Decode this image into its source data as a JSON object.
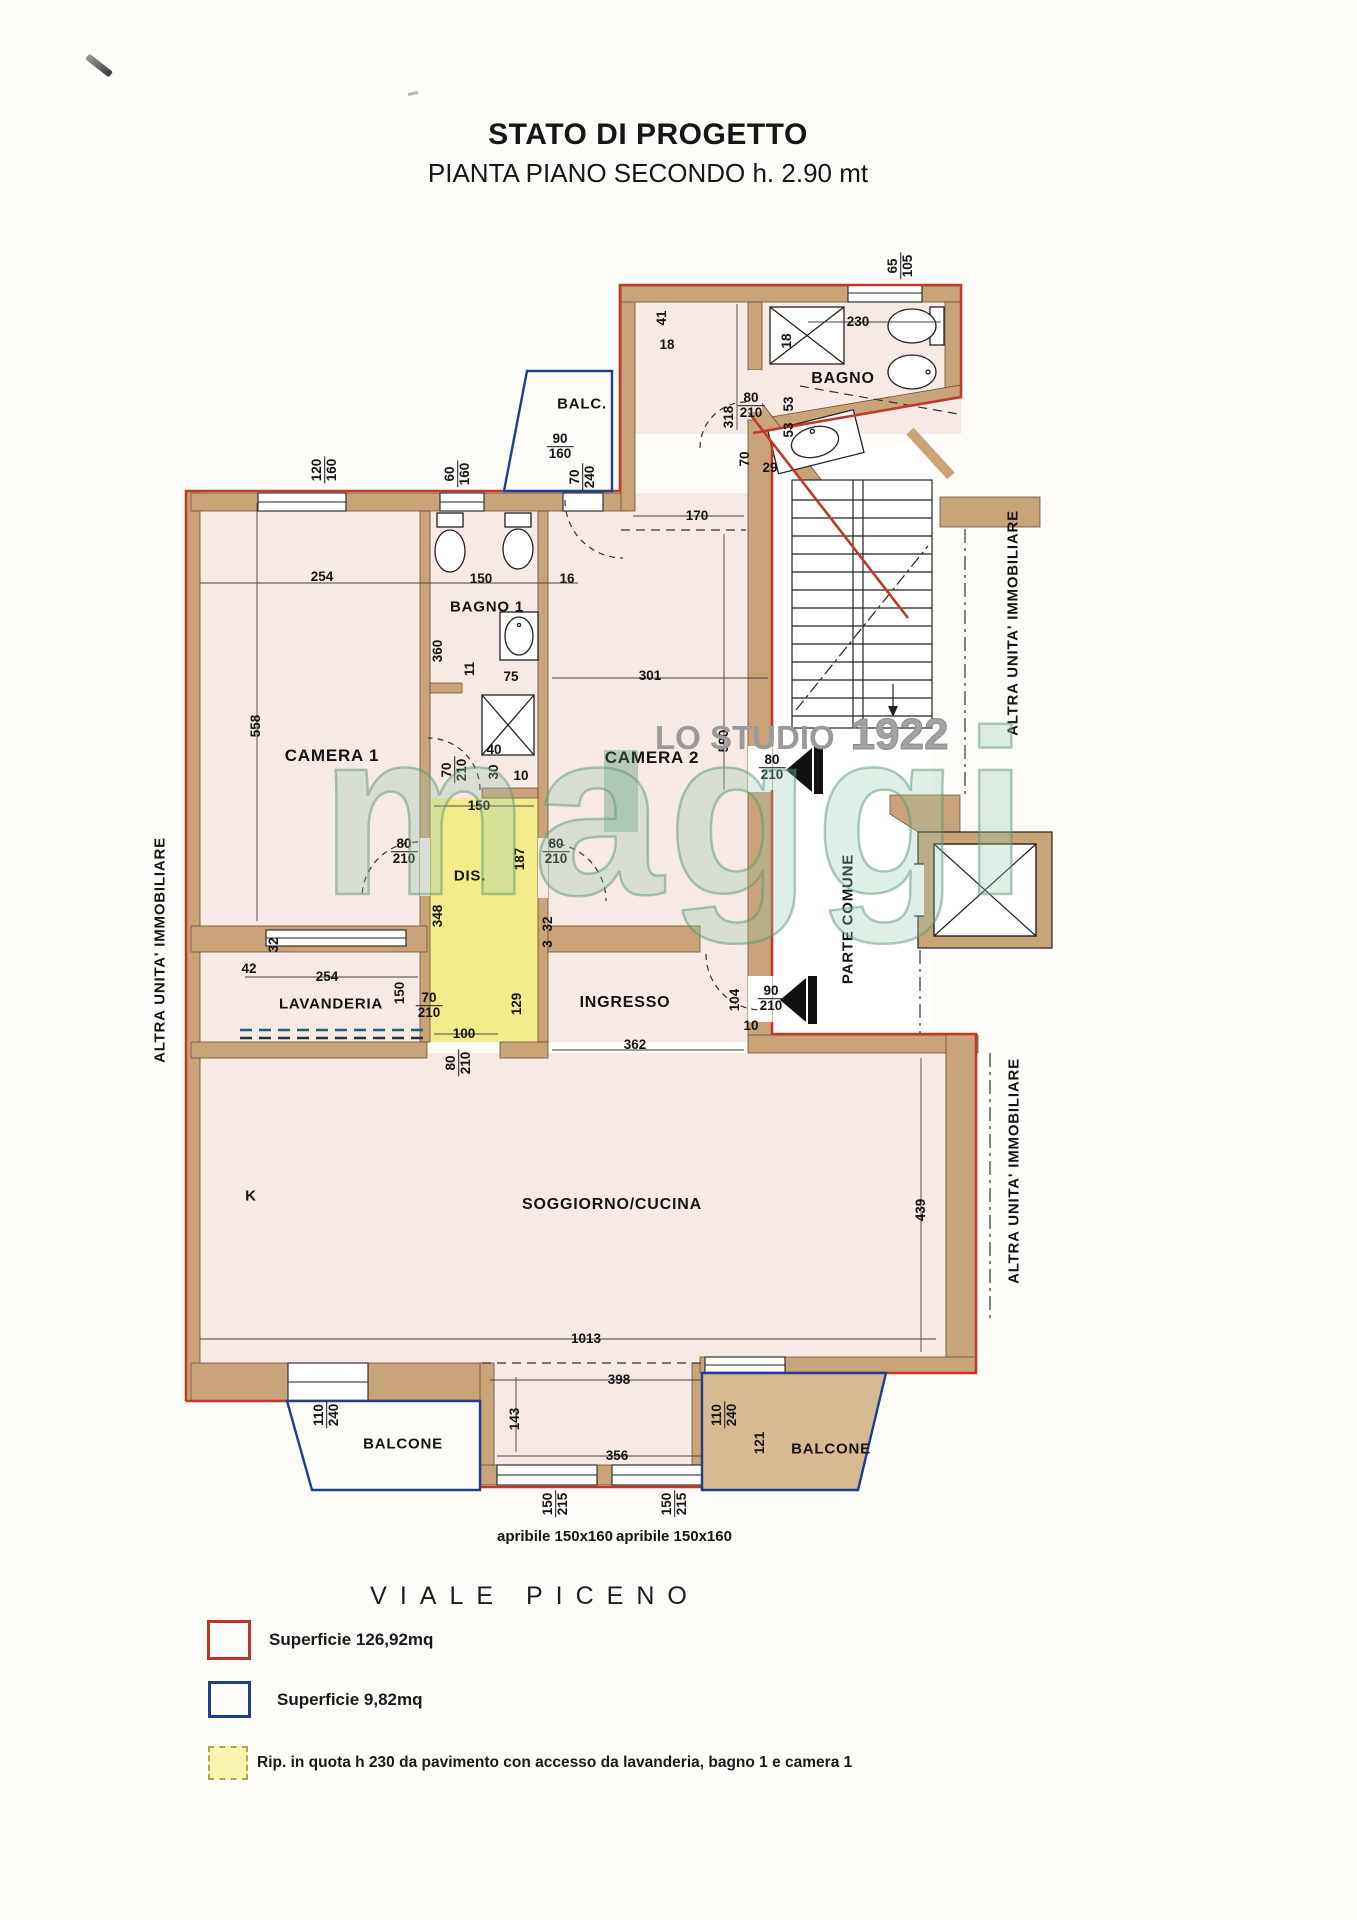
{
  "title": {
    "line1": "STATO DI PROGETTO",
    "line2": "PIANTA PIANO SECONDO h. 2.90 mt"
  },
  "street_label": "VIALE PICENO",
  "watermark": {
    "studio_label": "LO STUDIO",
    "year": "1922",
    "logo_text": "maggi"
  },
  "legend": [
    {
      "swatch": "red-outline",
      "color": "#c0332b",
      "label": "Superficie 126,92mq"
    },
    {
      "swatch": "blue-outline",
      "color": "#1c3f8e",
      "label": "Superficie 9,82mq"
    },
    {
      "swatch": "yellow-dashed",
      "color": "#f8f4ad",
      "label": "Rip. in quota h 230 da pavimento con accesso da lavanderia, bagno 1 e camera 1"
    }
  ],
  "colors": {
    "apartment_outline": "#bf3a2b",
    "balcony_outline": "#1c3f8e",
    "wall_fill": "#c9a478",
    "room_fill": "#f7e9e3",
    "ripostiglio_fill": "#f3ec8b",
    "watermark_green": "#7ab494"
  },
  "plan": {
    "labels": [
      {
        "t": "BALC.",
        "x": 582,
        "y": 404,
        "s": 15
      },
      {
        "t": "BAGNO",
        "x": 843,
        "y": 379,
        "s": 16
      },
      {
        "t": "BAGNO 1",
        "x": 487,
        "y": 607,
        "s": 15
      },
      {
        "t": "CAMERA 1",
        "x": 332,
        "y": 756,
        "s": 17
      },
      {
        "t": "CAMERA 2",
        "x": 652,
        "y": 758,
        "s": 17
      },
      {
        "t": "DIS.",
        "x": 470,
        "y": 876,
        "s": 15
      },
      {
        "t": "LAVANDERIA",
        "x": 331,
        "y": 1004,
        "s": 15
      },
      {
        "t": "INGRESSO",
        "x": 625,
        "y": 1003,
        "s": 16
      },
      {
        "t": "PARTE COMUNE",
        "x": 848,
        "y": 919,
        "r": -90,
        "s": 15
      },
      {
        "t": "SOGGIORNO/CUCINA",
        "x": 612,
        "y": 1205,
        "s": 16
      },
      {
        "t": "K",
        "x": 251,
        "y": 1196,
        "s": 15
      },
      {
        "t": "BALCONE",
        "x": 403,
        "y": 1444,
        "s": 15
      },
      {
        "t": "BALCONE",
        "x": 831,
        "y": 1449,
        "s": 15
      },
      {
        "t": "ALTRA UNITA' IMMOBILIARE",
        "x": 160,
        "y": 950,
        "r": -90,
        "s": 15
      },
      {
        "t": "ALTRA UNITA' IMMOBILIARE",
        "x": 1013,
        "y": 623,
        "r": -90,
        "s": 15
      },
      {
        "t": "ALTRA UNITA' IMMOBILIARE",
        "x": 1014,
        "y": 1171,
        "r": -90,
        "s": 15
      }
    ],
    "dims": [
      {
        "t": "65",
        "t2": "105",
        "x": 901,
        "y": 266,
        "r": -90
      },
      {
        "t": "41",
        "x": 662,
        "y": 318,
        "r": -90
      },
      {
        "t": "18",
        "x": 667,
        "y": 345
      },
      {
        "t": "230",
        "x": 858,
        "y": 322
      },
      {
        "t": "18",
        "x": 787,
        "y": 341,
        "r": -90
      },
      {
        "t": "80",
        "t2": "210",
        "x": 751,
        "y": 406
      },
      {
        "t": "53",
        "x": 789,
        "y": 404,
        "r": -90
      },
      {
        "t": "53",
        "x": 789,
        "y": 430,
        "r": -90
      },
      {
        "t": "70",
        "x": 745,
        "y": 459,
        "r": -90
      },
      {
        "t": "29",
        "x": 770,
        "y": 468
      },
      {
        "t": "318",
        "x": 729,
        "y": 417,
        "r": -90
      },
      {
        "t": "170",
        "x": 697,
        "y": 516
      },
      {
        "t": "120",
        "t2": "160",
        "x": 325,
        "y": 470,
        "r": -90
      },
      {
        "t": "60",
        "t2": "160",
        "x": 458,
        "y": 474,
        "r": -90
      },
      {
        "t": "90",
        "t2": "160",
        "x": 560,
        "y": 447
      },
      {
        "t": "70",
        "t2": "240",
        "x": 583,
        "y": 477,
        "r": -90
      },
      {
        "t": "254",
        "x": 322,
        "y": 577
      },
      {
        "t": "150",
        "x": 481,
        "y": 579
      },
      {
        "t": "16",
        "x": 567,
        "y": 579
      },
      {
        "t": "558",
        "x": 256,
        "y": 726,
        "r": -90
      },
      {
        "t": "360",
        "x": 438,
        "y": 651,
        "r": -90
      },
      {
        "t": "11",
        "x": 470,
        "y": 669,
        "r": -90
      },
      {
        "t": "75",
        "x": 511,
        "y": 677
      },
      {
        "t": "301",
        "x": 650,
        "y": 676
      },
      {
        "t": "590",
        "x": 724,
        "y": 741,
        "r": -90
      },
      {
        "t": "80",
        "t2": "210",
        "x": 772,
        "y": 768
      },
      {
        "t": "40",
        "x": 494,
        "y": 750
      },
      {
        "t": "30",
        "x": 494,
        "y": 772,
        "r": -90
      },
      {
        "t": "10",
        "x": 521,
        "y": 776
      },
      {
        "t": "70",
        "t2": "210",
        "x": 455,
        "y": 770,
        "r": -90
      },
      {
        "t": "150",
        "x": 479,
        "y": 806
      },
      {
        "t": "80",
        "t2": "210",
        "x": 404,
        "y": 852
      },
      {
        "t": "80",
        "t2": "210",
        "x": 556,
        "y": 852
      },
      {
        "t": "187",
        "x": 520,
        "y": 859,
        "r": -90
      },
      {
        "t": "348",
        "x": 438,
        "y": 916,
        "r": -90
      },
      {
        "t": "32",
        "x": 548,
        "y": 924,
        "r": -90
      },
      {
        "t": "3",
        "x": 548,
        "y": 944,
        "r": -90
      },
      {
        "t": "42",
        "x": 249,
        "y": 969
      },
      {
        "t": "32",
        "x": 274,
        "y": 945,
        "r": -90
      },
      {
        "t": "254",
        "x": 327,
        "y": 977
      },
      {
        "t": "150",
        "x": 400,
        "y": 993,
        "r": -90
      },
      {
        "t": "70",
        "t2": "210",
        "x": 429,
        "y": 1006
      },
      {
        "t": "100",
        "x": 464,
        "y": 1034
      },
      {
        "t": "80",
        "t2": "210",
        "x": 459,
        "y": 1063,
        "r": -90
      },
      {
        "t": "129",
        "x": 517,
        "y": 1004,
        "r": -90
      },
      {
        "t": "362",
        "x": 635,
        "y": 1045
      },
      {
        "t": "104",
        "x": 735,
        "y": 1000,
        "r": -90
      },
      {
        "t": "10",
        "x": 751,
        "y": 1026
      },
      {
        "t": "90",
        "t2": "210",
        "x": 771,
        "y": 999
      },
      {
        "t": "439",
        "x": 921,
        "y": 1210,
        "r": -90
      },
      {
        "t": "1013",
        "x": 586,
        "y": 1339
      },
      {
        "t": "398",
        "x": 619,
        "y": 1380
      },
      {
        "t": "143",
        "x": 515,
        "y": 1419,
        "r": -90
      },
      {
        "t": "356",
        "x": 617,
        "y": 1456
      },
      {
        "t": "110",
        "t2": "240",
        "x": 327,
        "y": 1415,
        "r": -90
      },
      {
        "t": "110",
        "t2": "240",
        "x": 725,
        "y": 1415,
        "r": -90
      },
      {
        "t": "121",
        "x": 760,
        "y": 1443,
        "r": -90
      },
      {
        "t": "150",
        "t2": "215",
        "x": 556,
        "y": 1504,
        "r": -90
      },
      {
        "t": "150",
        "t2": "215",
        "x": 675,
        "y": 1504,
        "r": -90
      },
      {
        "t": "apribile 150x160",
        "x": 555,
        "y": 1537,
        "s": 15
      },
      {
        "t": "apribile 150x160",
        "x": 674,
        "y": 1537,
        "s": 15
      }
    ]
  }
}
